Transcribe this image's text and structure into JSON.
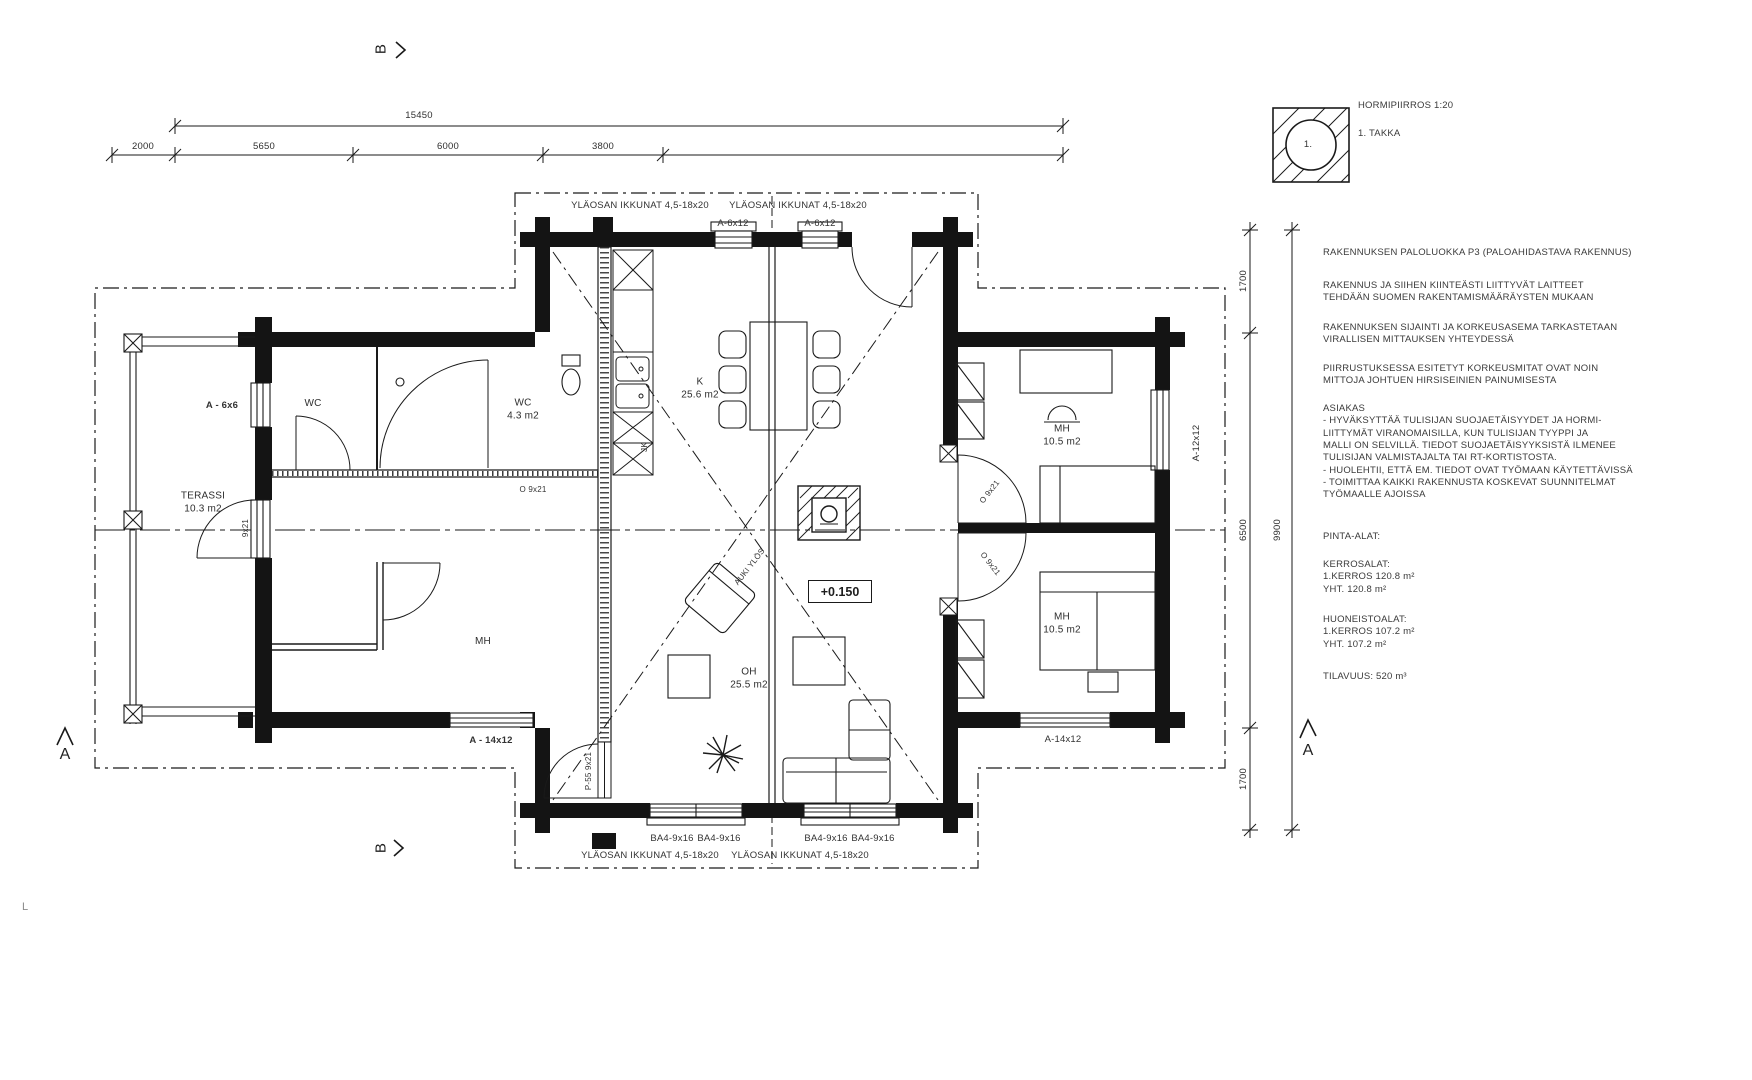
{
  "canvas": {
    "bg": "#ffffff",
    "ink": "#1a1a1a"
  },
  "dims_top": {
    "total": "15450",
    "seg1": "2000",
    "seg2": "5650",
    "seg3": "6000",
    "seg4": "3800"
  },
  "dims_right": {
    "seg1": "1700",
    "seg2": "6500",
    "seg3": "1700",
    "total": "9900"
  },
  "chimney_detail": {
    "title": "HORMIPIIRROS 1:20",
    "item": "1. TAKKA",
    "num": "1."
  },
  "notes": {
    "n1": "RAKENNUKSEN PALOLUOKKA P3 (PALOAHIDASTAVA RAKENNUS)",
    "n2": "RAKENNUS JA SIIHEN KIINTEÄSTI LIITTYVÄT LAITTEET\nTEHDÄÄN SUOMEN RAKENTAMISMÄÄRÄYSTEN MUKAAN",
    "n3": "RAKENNUKSEN SIJAINTI JA KORKEUSASEMA TARKASTETAAN\nVIRALLISEN MITTAUKSEN YHTEYDESSÄ",
    "n4": "PIIRRUSTUKSESSA ESITETYT KORKEUSMITAT OVAT NOIN\nMITTOJA JOHTUEN HIRSISEINIEN PAINUMISESTA",
    "n5": "ASIAKAS\n- HYVÄKSYTTÄÄ TULISIJAN SUOJAETÄISYYDET JA HORMI-\nLIITTYMÄT VIRANOMAISILLA, KUN TULISIJAN TYYPPI JA\nMALLI ON SELVILLÄ. TIEDOT SUOJAETÄISYYKSISTÄ ILMENEE\nTULISIJAN VALMISTAJALTA TAI RT-KORTISTOSTA.\n- HUOLEHTII, ETTÄ EM. TIEDOT OVAT TYÖMAAN KÄYTETTÄVISSÄ\n- TOIMITTAA KAIKKI RAKENNUSTA KOSKEVAT SUUNNITELMAT\n TYÖMAALLE AJOISSA",
    "n6": "PINTA-ALAT:",
    "n7": "KERROSALAT:\n1.KERROS 120.8 m²\nYHT. 120.8 m²",
    "n8": "HUONEISTOALAT:\n1.KERROS 107.2 m²\nYHT. 107.2 m²",
    "n9": "TILAVUUS: 520 m³"
  },
  "rooms": {
    "wc1": {
      "name": "WC",
      "area": ""
    },
    "wc2": {
      "name": "WC",
      "area": "4.3 m2"
    },
    "terassi": {
      "name": "TERASSI",
      "area": "10.3 m2"
    },
    "mh_left": {
      "name": "MH",
      "area": ""
    },
    "k": {
      "name": "K",
      "area": "25.6 m2"
    },
    "oh": {
      "name": "OH",
      "area": "25.5 m2"
    },
    "mh_top_right": {
      "name": "MH",
      "area": "10.5 m2"
    },
    "mh_bottom_right": {
      "name": "MH",
      "area": "10.5 m2"
    }
  },
  "openings": {
    "upper_windows": "YLÄOSAN IKKUNAT 4,5-18x20",
    "a6x12": "A-6x12",
    "a6x6": "A - 6x6",
    "a12x12": "A-12x12",
    "a14x12_left": "A - 14x12",
    "a14x12_right": "A-14x12",
    "ba4": "BA4-9x16",
    "o9x21": "O 9x21",
    "p55": "P-55 9x21",
    "terrace_door": "9x21",
    "fridge": "JK"
  },
  "markers": {
    "level": "+0.150",
    "auki": "AUKI YLÖS",
    "section_a": "A",
    "section_b": "B",
    "stray": "L"
  }
}
